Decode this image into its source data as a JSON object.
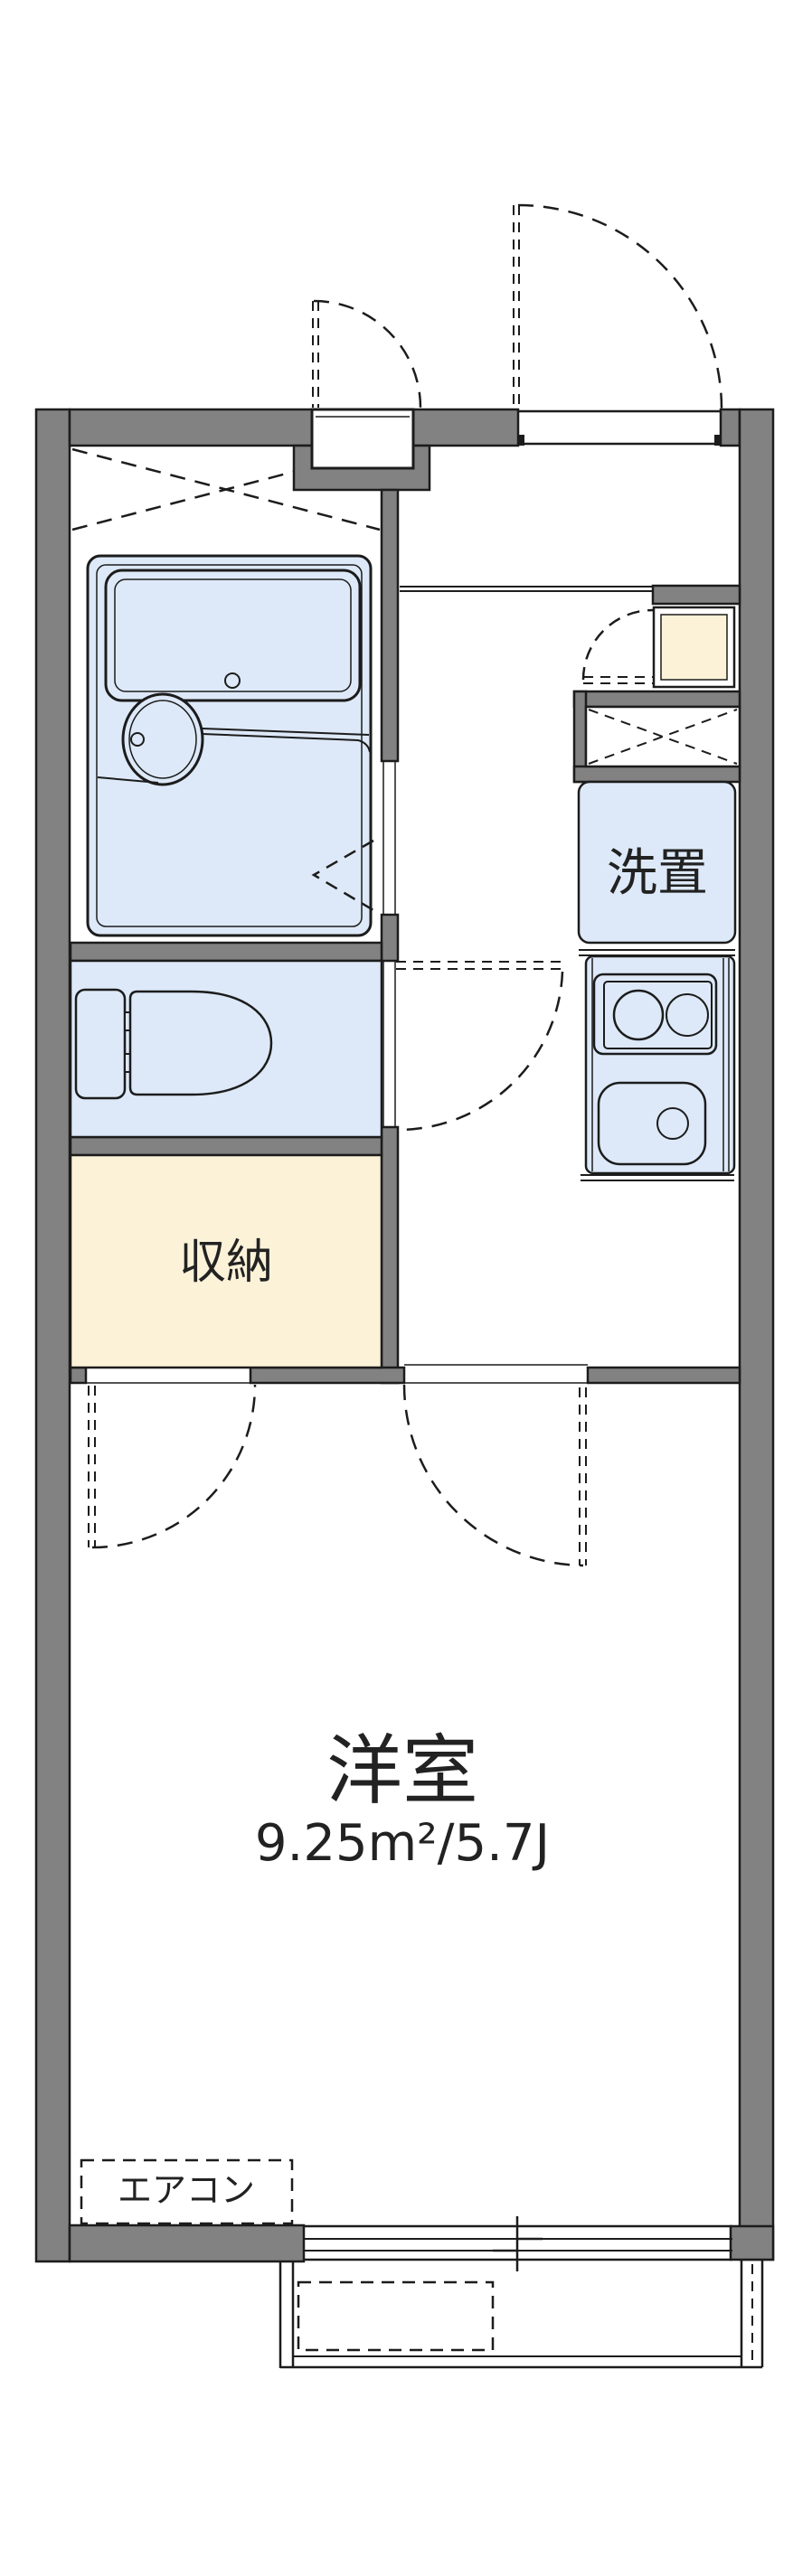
{
  "labels": {
    "bedroom": "洋室",
    "bedroom_size": "9.25m²/5.7J",
    "storage": "収納",
    "laundry": "洗置",
    "aircon": "エアコン"
  },
  "colors": {
    "wall_gray": "#828282",
    "fixture_blue": "#dde9f8",
    "storage_cream": "#fbf2d8",
    "line_black": "#1c1c1c",
    "background": "#ffffff"
  }
}
